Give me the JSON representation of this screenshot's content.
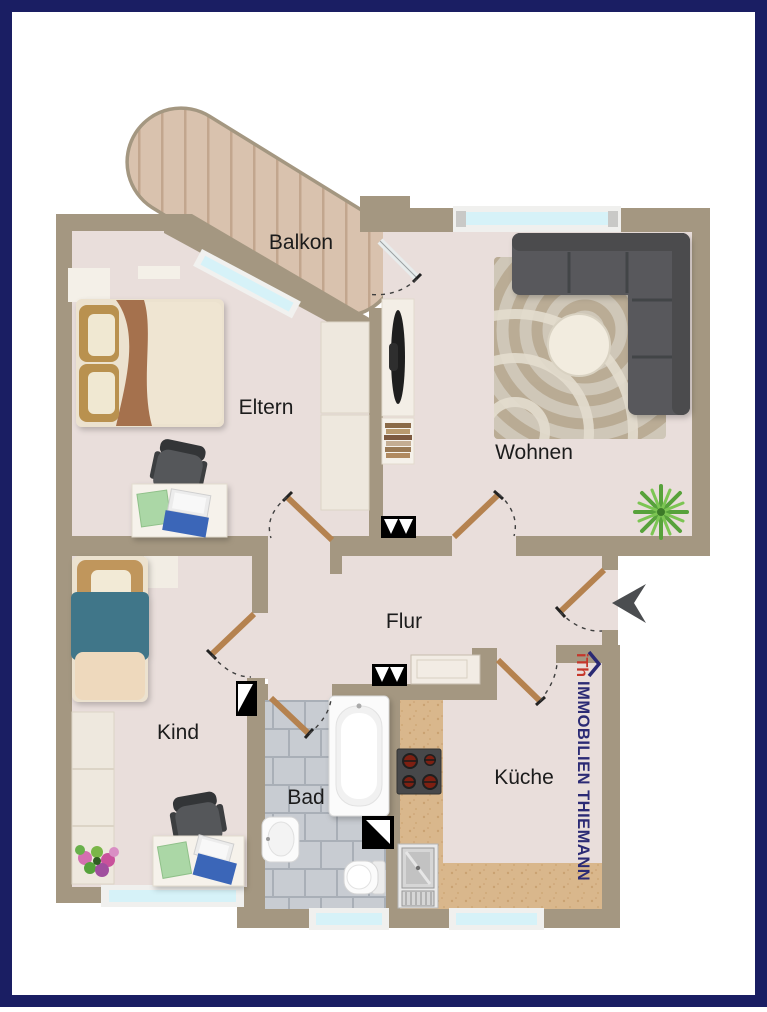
{
  "rooms": {
    "balkon": "Balkon",
    "eltern": "Eltern",
    "wohnen": "Wohnen",
    "flur": "Flur",
    "kind": "Kind",
    "bad": "Bad",
    "kueche": "Küche"
  },
  "branding": {
    "logo_text": "iTh",
    "company": "IMMOBILIEN THIEMANN"
  },
  "colors": {
    "border_navy": "#1a1e63",
    "wall_taupe": "#a49781",
    "floor_pink": "#e9dedb",
    "balcony_wood": "#d9c2ae",
    "bath_tile": "#c8ccd2",
    "kitchen_counter": "#d9b78c",
    "window_glass": "#d6f2f8",
    "door_wood": "#b5824f",
    "logo_navy": "#2b2a74",
    "logo_red": "#c5372b",
    "sofa_gray": "#58595b"
  }
}
